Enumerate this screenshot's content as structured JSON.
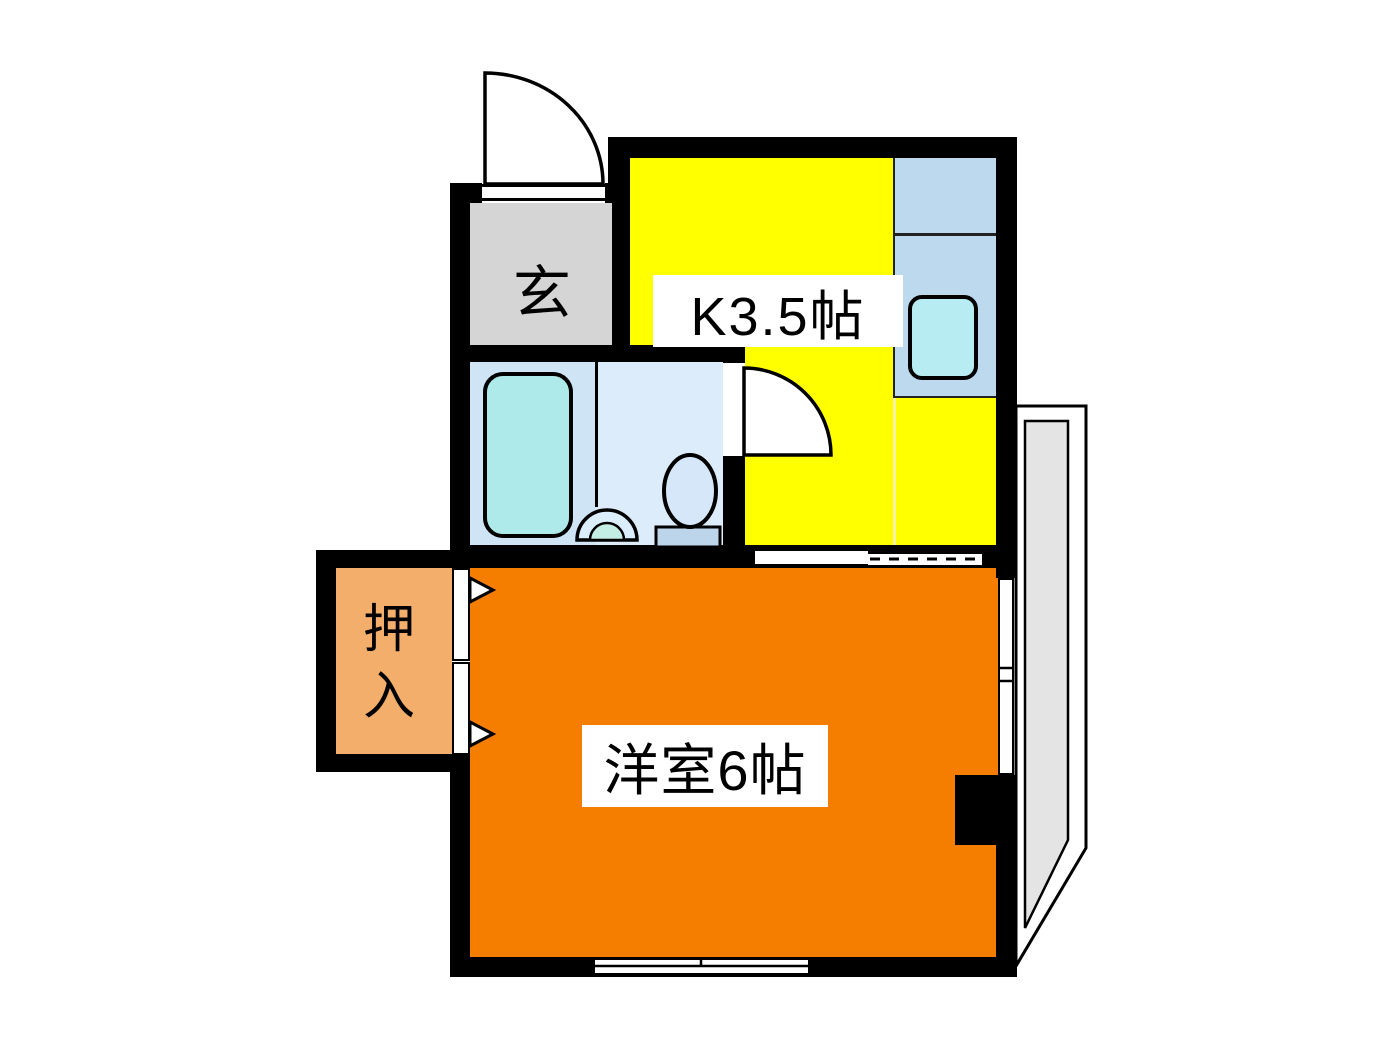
{
  "page": {
    "title": "間取り図"
  },
  "floorplan": {
    "wall_color": "#000000",
    "rooms": {
      "genkan": {
        "label": "玄",
        "color": "#d5d5d5"
      },
      "kitchen": {
        "label": "K3.5帖",
        "color": "#ffff00"
      },
      "western_room": {
        "label": "洋室6帖",
        "color": "#f57e00"
      },
      "closet": {
        "label": "押入",
        "chars": [
          "押",
          "入"
        ],
        "color": "#f3ae6b"
      },
      "bathroom": {
        "color": "#d6e8f8",
        "fixtures": [
          "bathtub",
          "toilet",
          "washbasin"
        ]
      },
      "balcony": {
        "color": "#e4e4e4"
      }
    },
    "fixture_colors": {
      "bathtub": "#aeeaea",
      "kitchen_counter": "#bcd9ee",
      "kitchen_sink": "#b6ecf2",
      "toilet_bowl": "#d5e7f8",
      "toilet_tank": "#bdd5eb",
      "washbasin_inner": "#c4eee3"
    }
  }
}
